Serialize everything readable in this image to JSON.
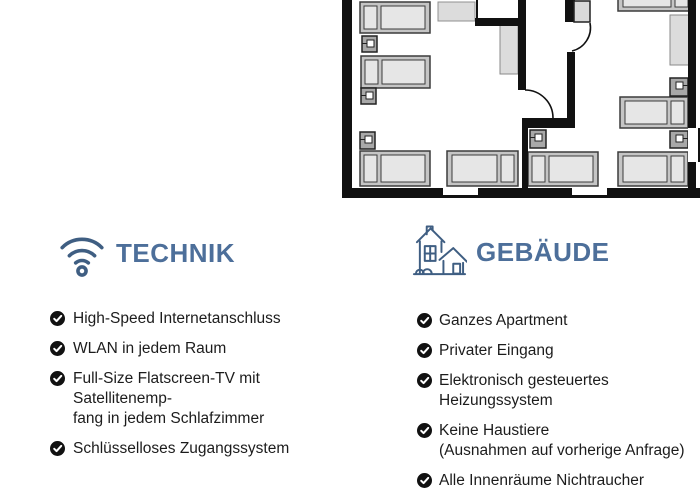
{
  "technik": {
    "heading": "TECHNIK",
    "icon": "wifi-icon",
    "items": [
      {
        "lines": [
          "High-Speed Internetanschluss"
        ]
      },
      {
        "lines": [
          "WLAN in jedem Raum"
        ]
      },
      {
        "lines": [
          "Full-Size Flatscreen-TV mit Satellitenemp-",
          "fang in jedem Schlafzimmer"
        ]
      },
      {
        "lines": [
          "Schlüsselloses Zugangssystem"
        ]
      }
    ]
  },
  "gebaeude": {
    "heading": "GEBÄUDE",
    "icon": "house-icon",
    "items": [
      {
        "lines": [
          "Ganzes Apartment"
        ]
      },
      {
        "lines": [
          "Privater Eingang"
        ]
      },
      {
        "lines": [
          "Elektronisch gesteuertes Heizungssystem"
        ]
      },
      {
        "lines": [
          "Keine Haustiere",
          "(Ausnahmen auf vorherige Anfrage)"
        ]
      },
      {
        "lines": [
          "Alle Innenräume Nichtraucher"
        ]
      }
    ]
  },
  "floorplan": {
    "type": "apartment-floor-plan",
    "beds": 8,
    "nightstands": 6,
    "wardrobes": 3,
    "doors": 2,
    "windows": 3
  },
  "colors": {
    "accent": "#4d6f9a",
    "icon_stroke": "#3f5e82",
    "text": "#1c1c1c",
    "wall": "#111111",
    "bed_frame": "#c5c5c5",
    "bed_pad": "#e6e6e6",
    "nightstand": "#a8a8a8",
    "furniture": "#dcdcdc",
    "check_background": "#111111"
  }
}
